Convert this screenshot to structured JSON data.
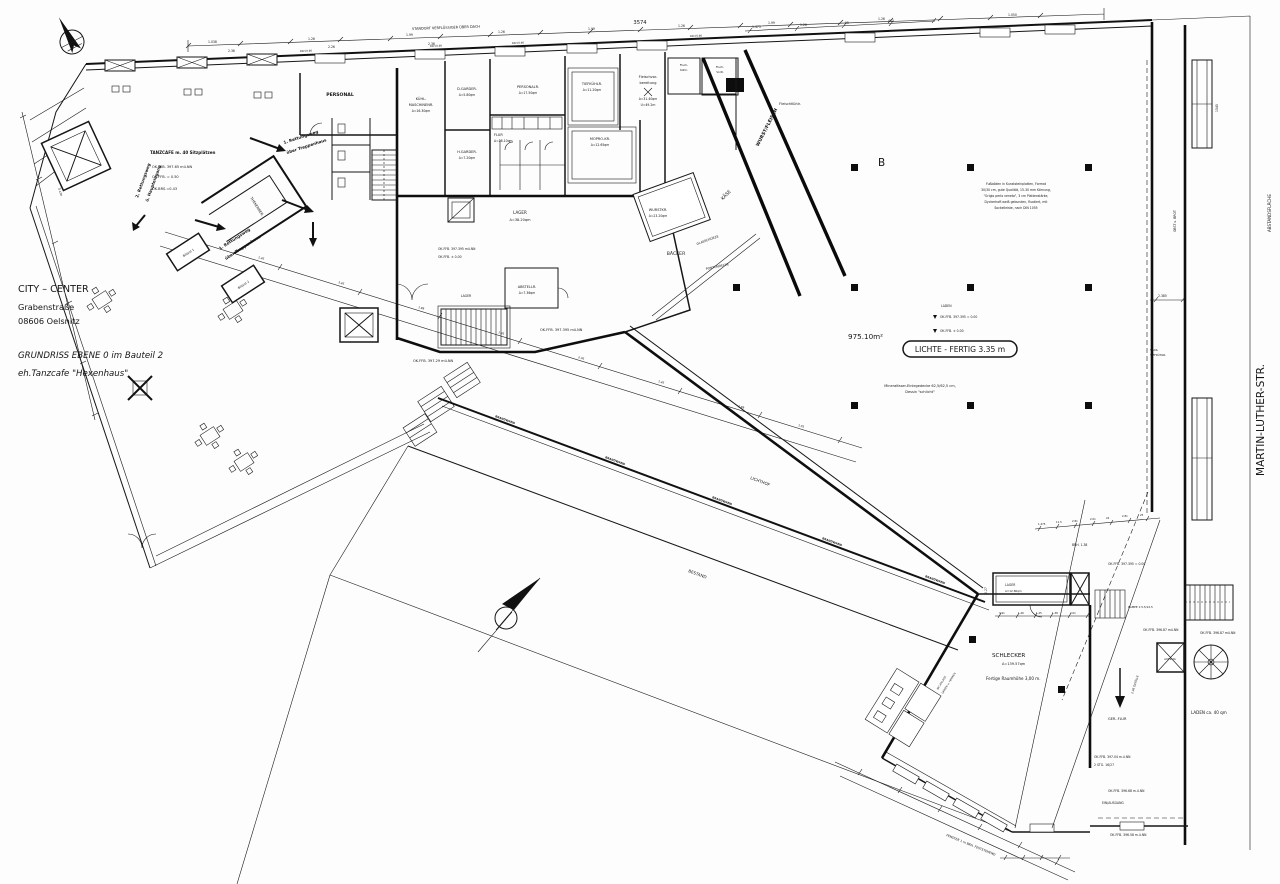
{
  "title_block": {
    "line1": "CITY  –  CENTER",
    "line2": "Grabenstraße",
    "line3": "08606 Oelsnitz",
    "line4": "GRUNDRISS EBENE 0 im Bauteil 2",
    "line5": "eh.Tanzcafe \"Hexenhaus\""
  },
  "streets": {
    "main": "MARTIN-LUTHER-STR.",
    "setback": "ABSTANDSFLÄCHE"
  },
  "notes": {
    "roof": "STANDORT VERFLÜSSIGER ÜBER DACH",
    "floor": [
      "Fußböden in Kunststeinplatten, Format",
      "30/30 cm, gute Qualität, 15-30 mm Körnung,",
      "\"Grigio perla veneto\", 3 cm Plattenstärke,",
      "Dyckerhoff-weiß gebunden, fluatiert, mit",
      "Sockelleiste, nach DIN 1055"
    ],
    "ceiling1": "Mineralfaser-Einlegedecke 62,5/62,5 cm,",
    "ceiling2": "Dessin \"schlicht\"",
    "area": "975.10m²",
    "clearance": "LICHTE - FERTIG 3.35 m",
    "axis": "B",
    "height": "Fertige Raumhöhe 3,00 m.",
    "window": "FENSTER 1 m BRH. FESTSTEHEND",
    "einausgang": "EIN/AUSGANG",
    "stg": "2 STG. 16/27",
    "ramp": "RAMPE 1:5,5/12,5",
    "laden": "LADEN ca. 40 qm",
    "glas": "GLASSCHÜRZE",
    "ponton": "PONTONDECKE",
    "gefaelle": "2.46 GEFÄLLE"
  },
  "escape": {
    "e1a": "1. Rettungsweg",
    "e1b": "über Treppenhaus",
    "e2a": "2. Rettungsweg",
    "e2b": "ü. Haupteingang"
  },
  "levels": {
    "l1": "OK.FFB. 397.65 mü.NN",
    "l2": "OK.FFB. = 0.50",
    "l3": "OK.BRS.=0.43",
    "l4": "OK.FFB. 397.395 mü.NN",
    "l5": "OK.FFB. ± 0.00",
    "l6": "OK.FFB. 396.87 mü.NN",
    "l7": "OK.FFB. 397.04 m.ü.NN",
    "l8": "OK.FFB. 396.68 m.ü.NN",
    "l9": "OK.FFB. 396.58 m.ü.NN",
    "l10": "OK.FFB. 397.29 mü.NN",
    "l11": "LADEN",
    "l12": "OK.FFB. 397.395 = 0.00"
  },
  "rooms": {
    "personal": "PERSONAL",
    "tanzcafe": "TANZCAFE m. 40 Sitzplätzen",
    "kuehl1": "KÜHL-",
    "kuehl2": "MASCHINENR.",
    "kuehl3": "A=16.30qm",
    "dgarder": "D.GARDER.",
    "dgarder_a": "A=5.80qm",
    "hgarder": "H.GARDER.",
    "hgarder_a": "A=7.20qm",
    "personalr": "PERSONALR.",
    "personalr_a": "A=17.50qm",
    "flur": "FLUR",
    "flur_a": "A=28.10qm",
    "tiefkuehl": "TIEFKÜHLR.",
    "tiefkuehl_a": "A=11.20qm",
    "mopro": "MOPRO-KR.",
    "mopro_a": "A=12.65qm",
    "fleischvor1": "Fleischvor-",
    "fleischvor2": "bereitung",
    "fleischvor_a": "A=31.40qm",
    "fleischvor_u": "U=49.2m",
    "fk1": "Flsch-",
    "fk2": "Kühlr.",
    "fv1": "Flsch-",
    "fv2": "VorR.",
    "fleischkuehl": "FleischKühlr.",
    "wurstkr": "WURSTKR.",
    "wurstkr_a": "A=23.20qm",
    "wurstfleisch": "WURST/FLEISCH",
    "kaese": "KÄSE",
    "baecker": "BÄCKER",
    "lager_big": "LAGER",
    "lager_big_a": "A=38.20qm",
    "abstellr": "ABSTELLR.",
    "abstellr_a": "A=7.36qm",
    "lager_small": "LAGER",
    "lichthof": "LICHTHOF",
    "bestand": "BESTAND",
    "brandwand": "BRANDWAND",
    "schlecker": "SCHLECKER",
    "schlecker_a": "A=139.57qm",
    "lager_s": "LAGER",
    "lager_s_a": "A=12.80qm",
    "gerflur": "GER.-FLUR",
    "aufzug": "AUFZUG",
    "wc1": "WC-ANLAGE",
    "wc2": "DAMEN u. HERREN",
    "theke": "THEKENBER.",
    "billard1": "Billard 1",
    "billard2": "Billard 2",
    "obst": "OBST u. BROT",
    "sack1": "SACK-",
    "sack2": "TIEFKÜHLR."
  },
  "dims": {
    "total": "3574",
    "row1": [
      "1.038",
      "1.26",
      "1.99",
      "1.26",
      "1.99",
      "1.26",
      "1.99",
      "1.26",
      "1.050"
    ],
    "row2": [
      "2.36",
      "2.26",
      "2.36"
    ],
    "right_chain": [
      "1.475",
      "1.26",
      "95",
      "463"
    ],
    "hall_chain": [
      "1.475",
      "11.5",
      "2.81",
      "2.01",
      "24",
      "2.81",
      "25"
    ],
    "schlecker_chain": [
      "3.91",
      "1.26",
      "1.25",
      "1.38",
      "2.01"
    ],
    "site_chain": [
      "1.26",
      "3.26",
      "1.99",
      "1.26",
      "2.36",
      "1.26",
      "1.99",
      "1.05"
    ],
    "v_2385": "2.385",
    "v_227": "2.27",
    "v_1545": "1545",
    "brh_138": "BRH. 1.38",
    "brh_win": "BRH.0.90",
    "three_cm": "3 cm"
  }
}
